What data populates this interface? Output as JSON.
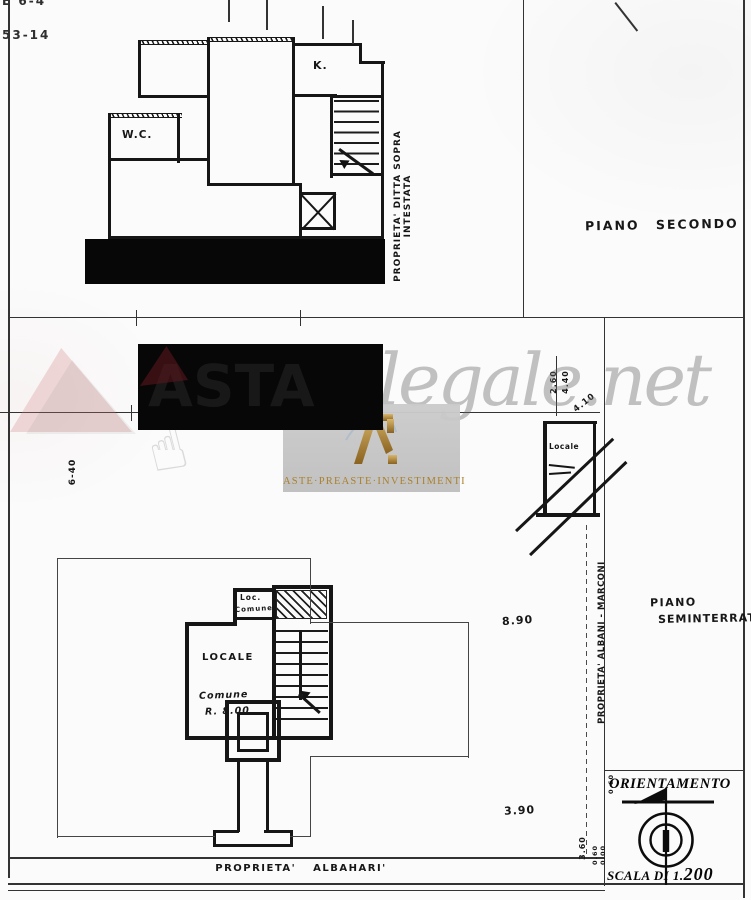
{
  "corner": {
    "line1": "E 6-4",
    "line2": "53-14"
  },
  "floor2": {
    "wc_label": "W.C.",
    "kitchen_label": "K.",
    "owner_note_line1": "PROPRIETA' DITTA SOPRA",
    "owner_note_line2": "INTESTATA",
    "title": "PIANO SECONDO"
  },
  "upper_locale": {
    "label": "Locale"
  },
  "basement": {
    "loc_label": "Loc.",
    "loc_sublabel": "Comune",
    "locale_label": "LOCALE",
    "comune_label": "Comune",
    "r800_label": "R. 8.00",
    "title_line1": "PIANO",
    "title_line2": "SEMINTERRATO",
    "owner_note": "PROPRIETA' ALBANI - MARCONI",
    "bottom_note": "PROPRIETA'  ALBAHARI'"
  },
  "dimensions": {
    "d640": "6-40",
    "d260": "2.60",
    "d440": "4.40",
    "d410": "4.10",
    "d890": "8.90",
    "d390": "3.90",
    "d360": "3.60",
    "d060a": "0.60",
    "d060b": "0.60",
    "d000": "0.00"
  },
  "orientation": {
    "title": "ORIENTAMENTO",
    "scale_prefix": "SCALA DI 1.",
    "scale_value": "200"
  },
  "watermarks": {
    "obscured_brand_text": "ASTA",
    "script_text": "legale.net",
    "badge_text": "ASTE·PREASTE·INVESTIMENTI",
    "gold_color": "#b08c3e",
    "badge_gray": "#c7c7c7"
  }
}
